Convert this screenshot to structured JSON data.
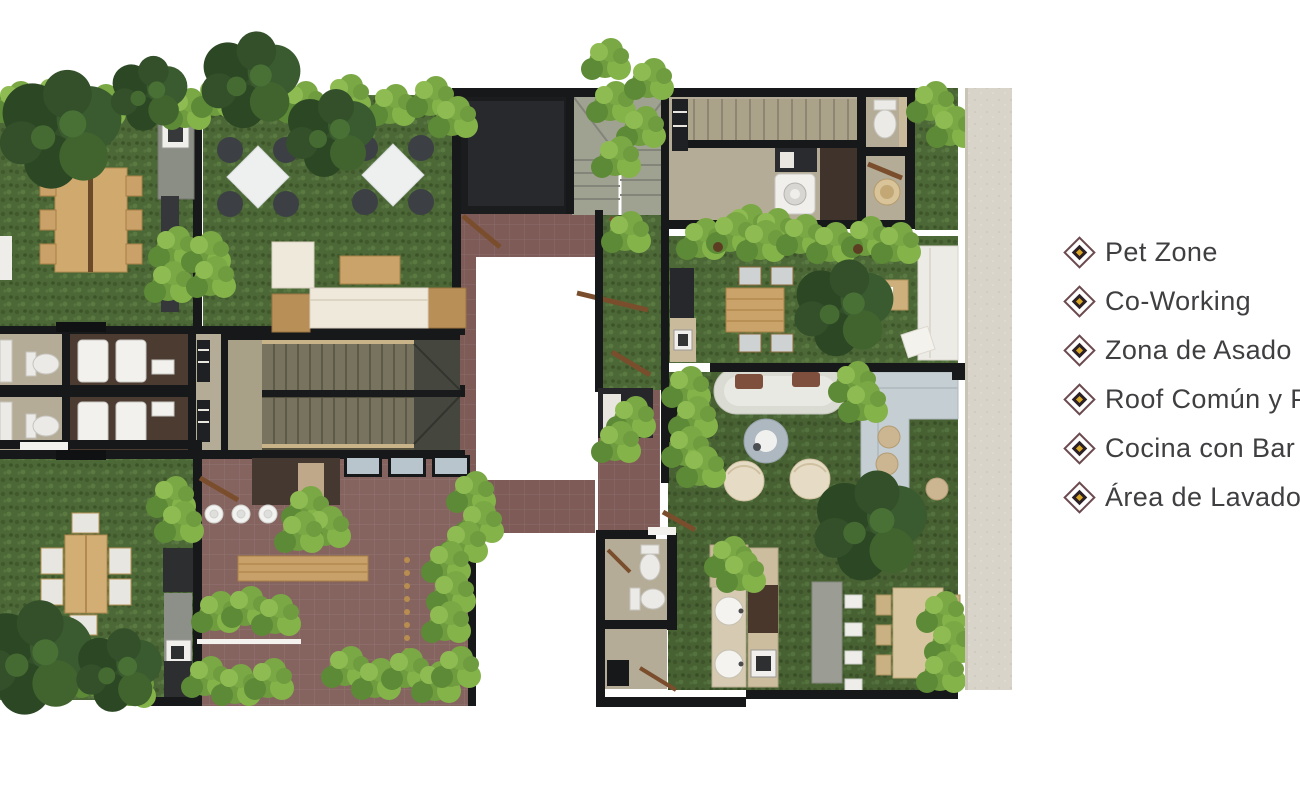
{
  "page": {
    "background": "#ffffff",
    "kind": "rooftop floor plan render with amenity legend"
  },
  "legend": {
    "text_color": "#3f3f41",
    "bullet": {
      "outer": "#6b4a50",
      "inner": "#2b2026",
      "gold": "#d8a628"
    },
    "items": [
      {
        "label": "Pet Zone"
      },
      {
        "label": "Co-Working"
      },
      {
        "label": "Zona de Asado"
      },
      {
        "label": "Roof Común y P"
      },
      {
        "label": "Cocina con Bar"
      },
      {
        "label": "Área de Lavado"
      }
    ]
  },
  "floor_plan": {
    "palette": {
      "grass": "#4c6836",
      "walls": "#17181a",
      "terracotta_tile": "#7e5b57",
      "interior_floor": "#b4ac96",
      "wood_furniture": "#c9a36a",
      "exterior_wall": "#d8d4ca",
      "foliage_dark": "#33502a",
      "foliage_light": "#7aa845"
    },
    "features": [
      "co-working tables",
      "pet zone lawns",
      "bbq grills",
      "central stairs",
      "elevator shaft",
      "skylight voids",
      "laundry room",
      "lounge sofas",
      "outdoor dining tables",
      "bathrooms",
      "kitchen with bar"
    ]
  }
}
